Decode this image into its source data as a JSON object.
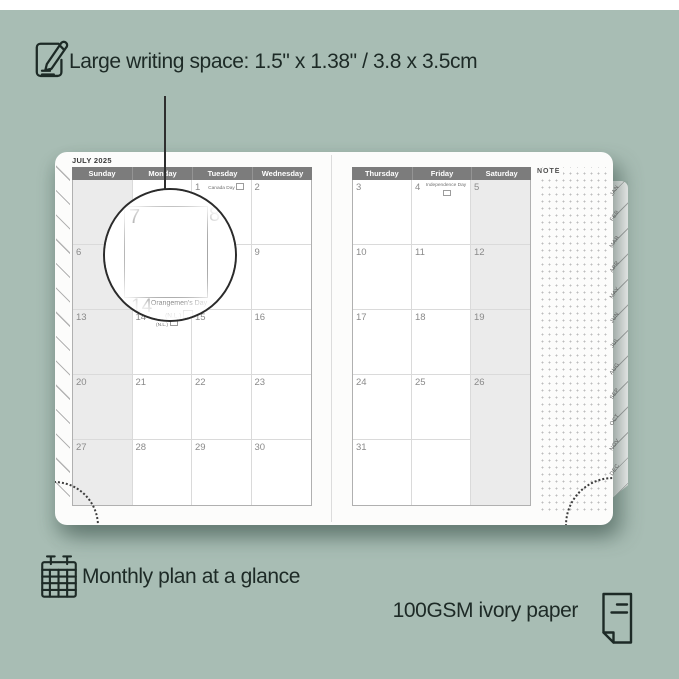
{
  "features": {
    "writing_space": {
      "text": "Large writing space: 1.5\" x 1.38\" / 3.8 x 3.5cm"
    },
    "monthly_plan": {
      "text": "Monthly plan at a glance"
    },
    "paper": {
      "text": "100GSM ivory paper"
    }
  },
  "planner": {
    "month_title": "JULY 2025",
    "note_label": "NOTE",
    "left_page": {
      "headers": [
        "Sunday",
        "Monday",
        "Tuesday",
        "Wednesday"
      ],
      "shaded_column": 0,
      "rows": [
        [
          {
            "day": ""
          },
          {
            "day": ""
          },
          {
            "day": "1",
            "holiday": "Canada Day",
            "flag": true
          },
          {
            "day": "2"
          }
        ],
        [
          {
            "day": "6"
          },
          {
            "day": "7"
          },
          {
            "day": "8"
          },
          {
            "day": "9"
          }
        ],
        [
          {
            "day": "13"
          },
          {
            "day": "14",
            "holiday": "Orangemen's Day (N.L.)",
            "flag": true
          },
          {
            "day": "15"
          },
          {
            "day": "16"
          }
        ],
        [
          {
            "day": "20"
          },
          {
            "day": "21"
          },
          {
            "day": "22"
          },
          {
            "day": "23"
          }
        ],
        [
          {
            "day": "27"
          },
          {
            "day": "28"
          },
          {
            "day": "29"
          },
          {
            "day": "30"
          }
        ]
      ]
    },
    "right_page": {
      "headers": [
        "Thursday",
        "Friday",
        "Saturday"
      ],
      "shaded_column": 2,
      "rows": [
        [
          {
            "day": "3"
          },
          {
            "day": "4",
            "holiday": "Independence Day",
            "flag": true
          },
          {
            "day": "5"
          }
        ],
        [
          {
            "day": "10"
          },
          {
            "day": "11"
          },
          {
            "day": "12"
          }
        ],
        [
          {
            "day": "17"
          },
          {
            "day": "18"
          },
          {
            "day": "19"
          }
        ],
        [
          {
            "day": "24"
          },
          {
            "day": "25"
          },
          {
            "day": "26"
          }
        ],
        [
          {
            "day": "31"
          },
          {
            "day": ""
          },
          {
            "day": ""
          }
        ]
      ]
    },
    "month_tabs": [
      "JAN",
      "FEB",
      "MAR",
      "APR",
      "MAY",
      "JUN",
      "JUL",
      "AUG",
      "SEP",
      "OCT",
      "NOV",
      "DEC"
    ],
    "magnifier": {
      "day_left": "7",
      "day_right": "8",
      "day_bottom": "14",
      "holiday_line1": "Orangemen's Day",
      "holiday_line2": "(N.L.)"
    }
  },
  "colors": {
    "background_green": "#a8bdb4",
    "feature_text": "#1d2a26",
    "day_header_bar": "#7c7c7c",
    "shaded_cell": "#ebebeb",
    "magnifier_ring": "#2b2b2b"
  }
}
